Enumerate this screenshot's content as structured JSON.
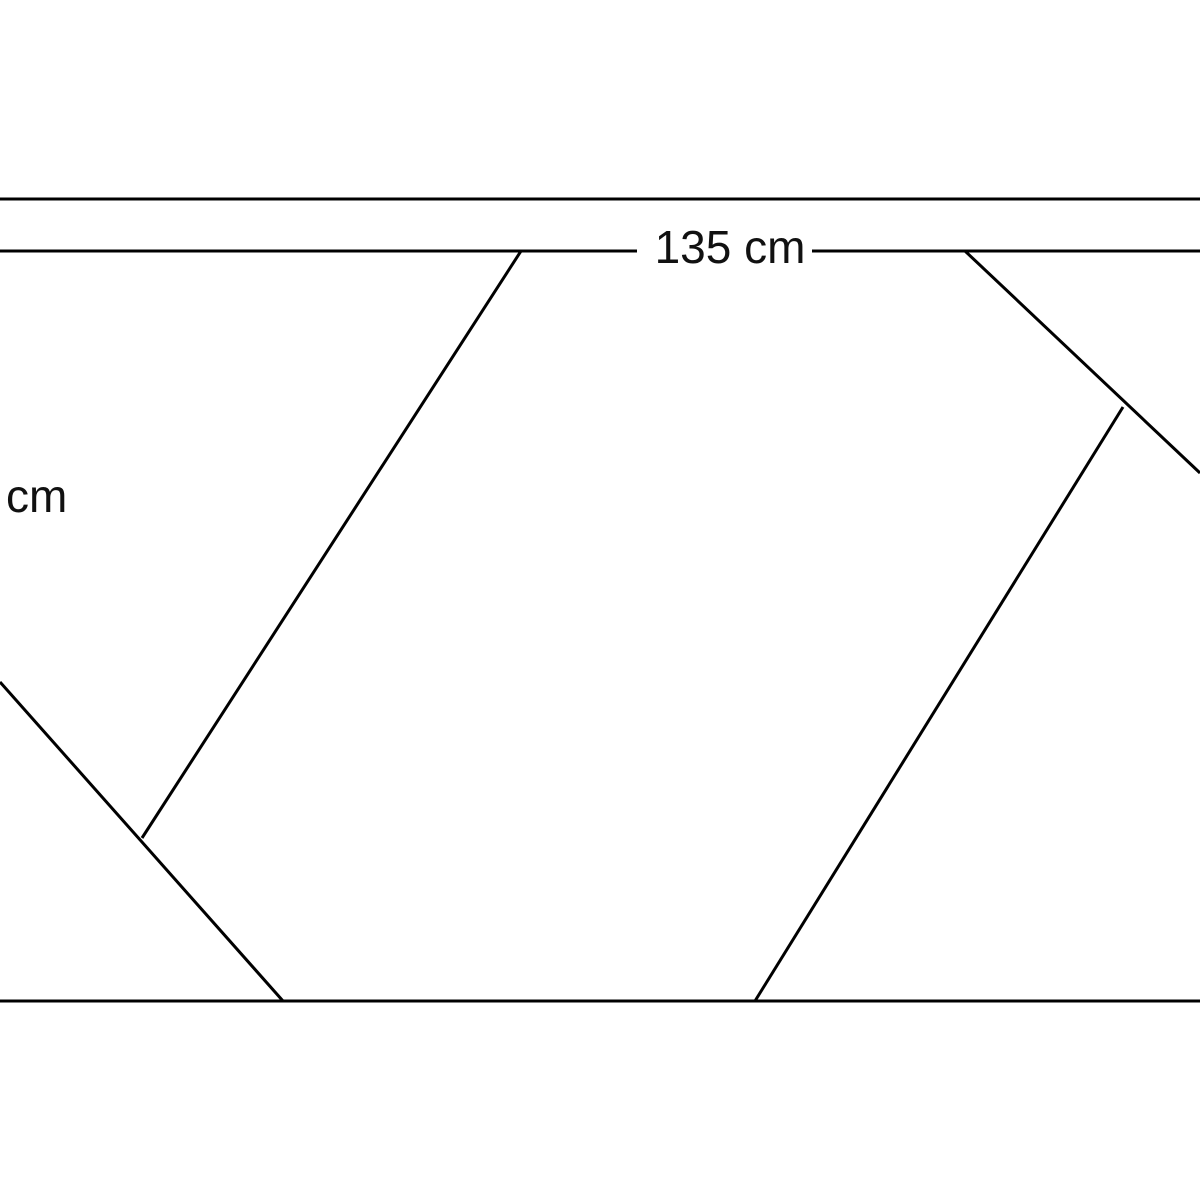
{
  "page": {
    "background_color": "#ffffff",
    "line_color": "#000000",
    "line_width": 3
  },
  "figure": {
    "type": "geometry-line-diagram",
    "top_label": {
      "text": "135 cm"
    },
    "left_label": {
      "text": "cm"
    },
    "lines": [
      {
        "name": "top-outer-horizontal",
        "x1": 0,
        "y1": 199,
        "x2": 1200,
        "y2": 199
      },
      {
        "name": "top-inner-horizontal-left",
        "x1": 0,
        "y1": 251,
        "x2": 637,
        "y2": 251
      },
      {
        "name": "top-inner-horizontal-right",
        "x1": 812,
        "y1": 251,
        "x2": 1200,
        "y2": 251
      },
      {
        "name": "bottom-horizontal",
        "x1": 0,
        "y1": 1001,
        "x2": 1200,
        "y2": 1001
      },
      {
        "name": "left-upper-diagonal",
        "x1": 521,
        "y1": 251,
        "x2": 142,
        "y2": 838
      },
      {
        "name": "left-lower-diagonal",
        "x1": 0,
        "y1": 682,
        "x2": 283,
        "y2": 1001
      },
      {
        "name": "right-upper-diagonal",
        "x1": 965,
        "y1": 251,
        "x2": 1200,
        "y2": 473
      },
      {
        "name": "right-lower-diagonal",
        "x1": 1123,
        "y1": 407,
        "x2": 755,
        "y2": 1001
      }
    ]
  }
}
